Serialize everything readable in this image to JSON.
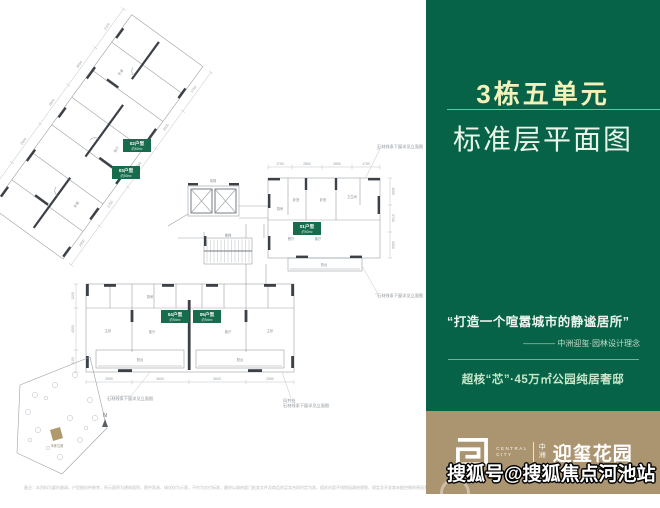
{
  "panel": {
    "building_title": "3栋五单元",
    "plan_title": "标准层平面图",
    "quote": "“打造一个喧嚣城市的静谧居所”",
    "quote_attribution": "———— 中洲迎玺·园林设计理念",
    "tagline": "超核“芯”·45万㎡公园纯居奢邸",
    "bg_color": "#076347"
  },
  "logo": {
    "brand_en_line1": "CENTRAL",
    "brand_en_line2": "CITY",
    "brand_cn_small": "中洲",
    "brand_cn_large": "迎玺花园",
    "bar_color": "#ab9470"
  },
  "watermark": {
    "text": "搜狐号@搜狐焦点河池站"
  },
  "plan": {
    "units": [
      {
        "name": "02户型",
        "area": "约62m²"
      },
      {
        "name": "03户型",
        "area": "约50m²"
      },
      {
        "name": "01户型",
        "area": "约92m²"
      },
      {
        "name": "04户型",
        "area": "约94m²"
      },
      {
        "name": "05户型",
        "area": "约94m²"
      }
    ],
    "room_labels": [
      "卧室",
      "卧室",
      "卫生间",
      "厨房",
      "餐厅",
      "客厅",
      "阳台",
      "主卧",
      "厨房",
      "客厅",
      "阳台",
      "客厅",
      "主卧",
      "阳台",
      "电梯",
      "楼梯",
      "卧室",
      "客厅",
      "卧室"
    ],
    "annotations": [
      "石材线条下窗详见立面图",
      "石材线条下窗详见立面图",
      "石材线条下窗详见立面图",
      "风井处",
      "石材线条下窗详见立面图"
    ],
    "dims": [
      "1750",
      "2850",
      "2850",
      "1750",
      "1500",
      "2700",
      "3300",
      "1050",
      "2550",
      "3600",
      "3600",
      "2550",
      "1050",
      "1200",
      "4200",
      "1100",
      "2900",
      "1750",
      "2850",
      "2900",
      "1750",
      "2100"
    ],
    "north_label": "N",
    "site_label": "本栋位置"
  },
  "footer": {
    "disclaimer": "备注：本资料为要约邀请，户型图仅供参考，所示面积为建筑面积，图中家具、绿化仅为示意，不作为交付标准；最终以政府部门批准文件及商品房买卖合同约定为准，相关内容不排除因政府规划、规定及开发商未能控制的原因发生变化，本公司保留法律范围内的解释权。"
  }
}
